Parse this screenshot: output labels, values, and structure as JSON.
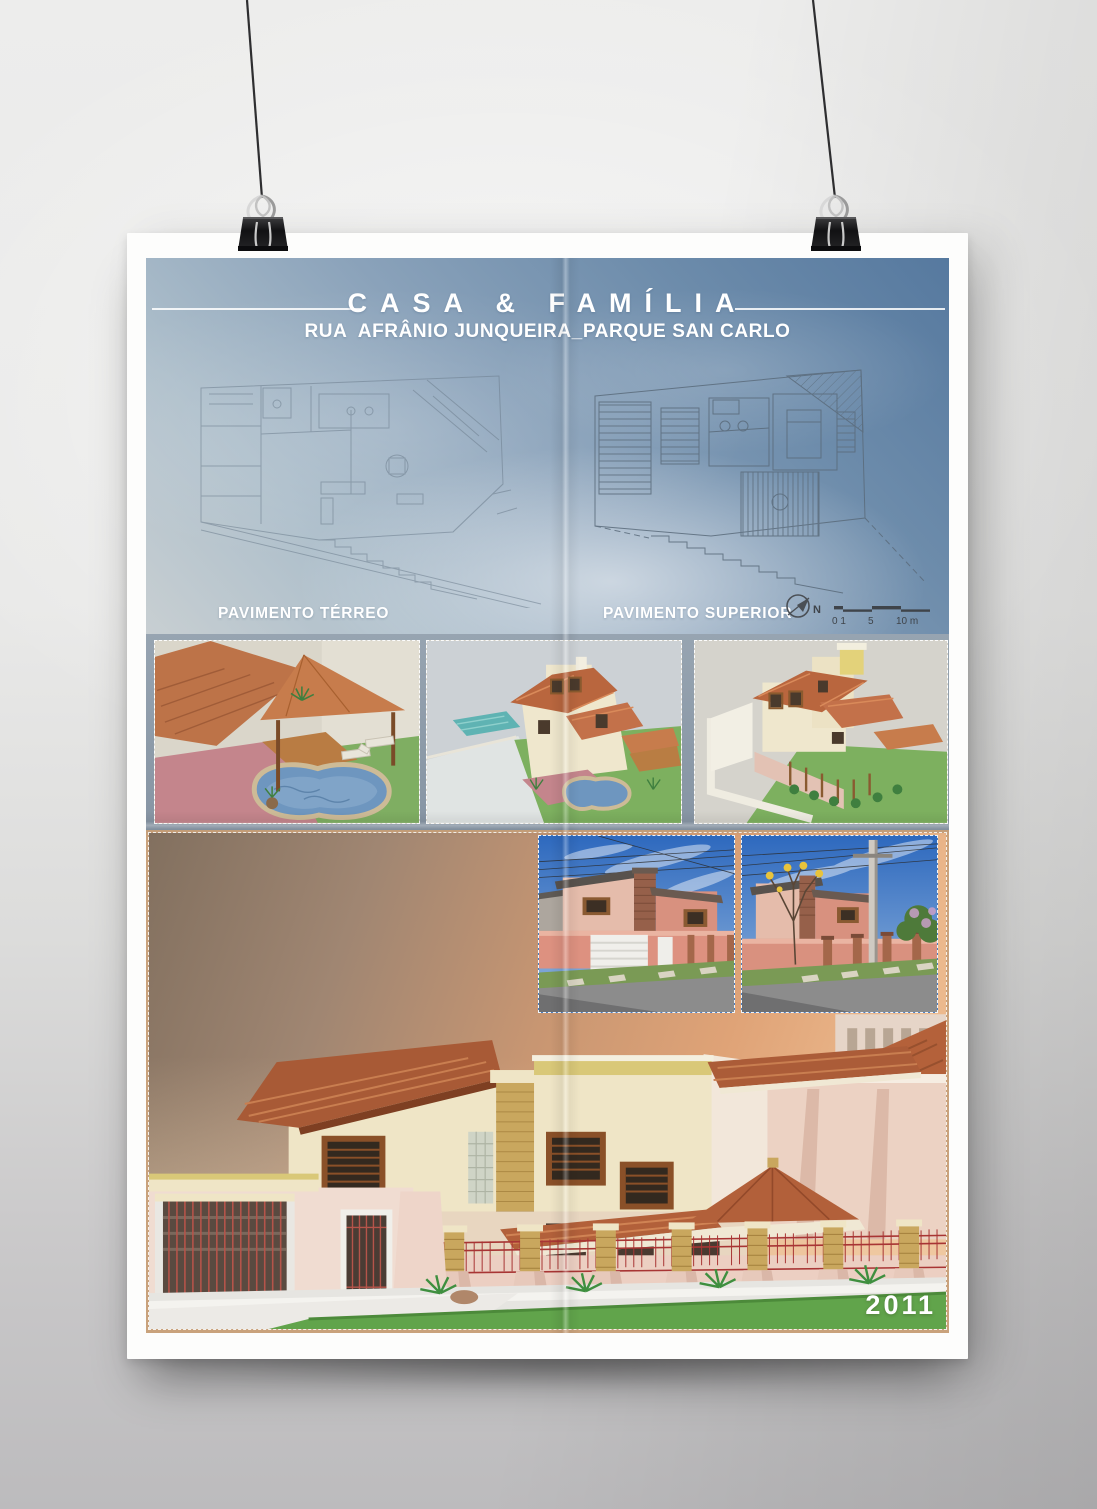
{
  "poster": {
    "header": {
      "title": "CASA & FAMÍLIA",
      "subtitle": "RUA  AFRÂNIO JUNQUEIRA_PARQUE SAN CARLO"
    },
    "plans": {
      "terreo_label": "PAVIMENTO TÉRREO",
      "superior_label": "PAVIMENTO SUPERIOR",
      "north_label": "N",
      "scale": {
        "s0": "0 1",
        "s1": "5",
        "s2": "10 m"
      }
    },
    "footer": {
      "year": "2011"
    },
    "icons": {
      "north_arrow": "north-arrow-compass",
      "binder_clip": "binder-clip",
      "scale_bar": "map-scale-bar"
    },
    "colors": {
      "sky_top": "#56799f",
      "sky_haze": "#c8cfd2",
      "strip_bg": "#8c9aa8",
      "sunset_dark": "#837163",
      "sunset_orange": "#e0a477",
      "roof_terracotta": "#b2603a",
      "wall_cream": "#efe5c6",
      "fence_pink": "#eccfc2",
      "brick_yellow": "#c9a75e",
      "grass_green": "#61a44b",
      "text_white": "#ffffff"
    }
  }
}
